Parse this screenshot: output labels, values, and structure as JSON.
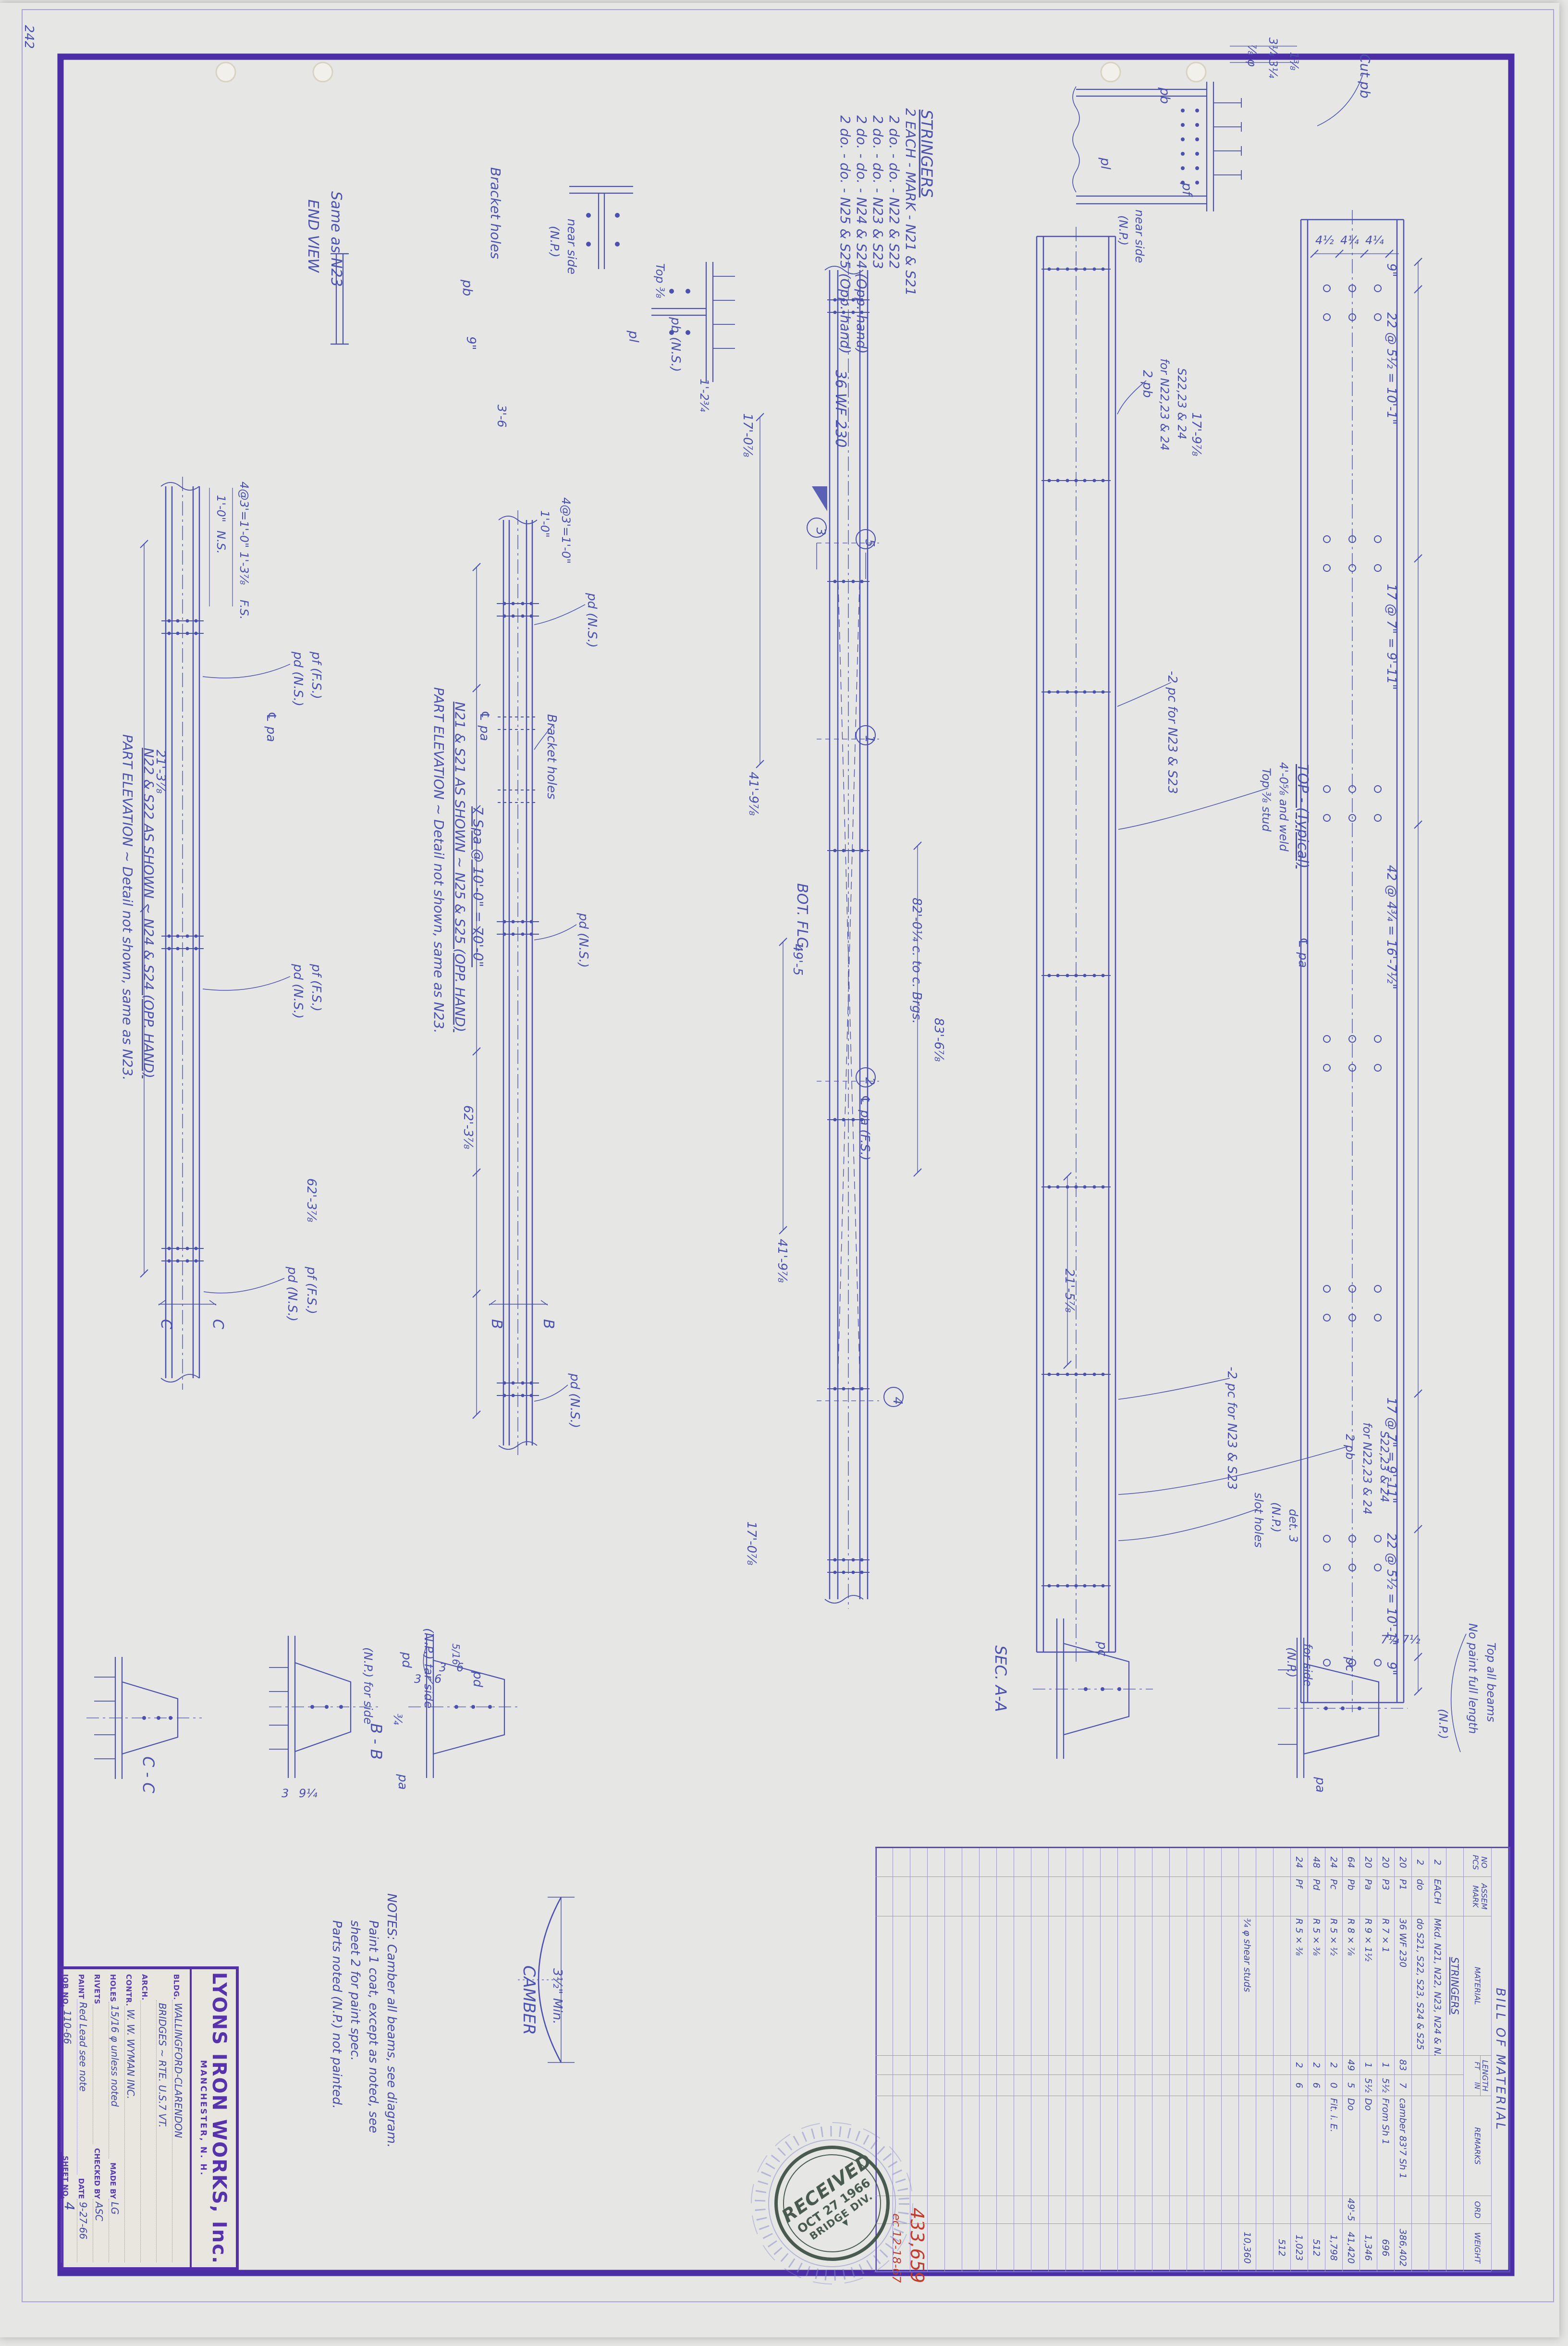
{
  "sheet_corner_number": "242",
  "title_block": {
    "company": "LYONS IRON WORKS, Inc.",
    "city": "MANCHESTER, N. H.",
    "bldg_label": "BLDG.",
    "bldg_value": "WALLINGFORD-CLARENDON",
    "bldg_value2": "BRIDGES ~ RTE. U.S.7  VT.",
    "arch_label": "ARCH.",
    "arch_value": "",
    "contr_label": "CONTR.",
    "contr_value": "W. W. WYMAN INC.",
    "holes_label": "HOLES",
    "holes_value": "15/16 φ unless noted",
    "madeby_label": "MADE BY",
    "madeby_value": "LG",
    "rivets_label": "RIVETS",
    "rivets_value": "",
    "checked_label": "CHECKED BY",
    "checked_value": "ASC",
    "paint_label": "PAINT",
    "paint_value": "Red Lead see note",
    "date_label": "DATE",
    "date_value": "9-27-66",
    "job_label": "JOB NO.",
    "job_value": "110-66",
    "sheet_label": "SHEET NO.",
    "sheet_value": "4"
  },
  "bom": {
    "title": "BILL OF MATERIAL",
    "headers": {
      "pcs1": "NO",
      "pcs2": "PCS",
      "mark1": "ASSEM",
      "mark2": "MARK",
      "material": "MATERIAL",
      "length": "LENGTH",
      "ft": "FT",
      "in": "IN",
      "remarks": "REMARKS",
      "ord": "ORD",
      "weight": "WEIGHT"
    },
    "rows": [
      [
        "",
        "",
        "STRINGERS",
        "",
        "",
        "",
        "",
        ""
      ],
      [
        "2",
        "EACH",
        "Mkd. N21, N22, N23, N24 & N25",
        "",
        "",
        "",
        "",
        ""
      ],
      [
        "2",
        "do",
        "do  S21, S22, S23, S24 & S25",
        "",
        "",
        "",
        "",
        ""
      ],
      [
        "20",
        "P1",
        "36 WF 230",
        "83",
        "7",
        "camber 83'7  Sh 1",
        "",
        "386,402"
      ],
      [
        "20",
        "P3",
        "R 7 × 1",
        "1",
        "5½",
        "From Sh 1",
        "",
        "696"
      ],
      [
        "20",
        "Pa",
        "R 9 × 1½",
        "1",
        "5½",
        "Do",
        "",
        "1,346"
      ],
      [
        "64",
        "Pb",
        "R 8 × ⅞",
        "49",
        "5",
        "Do",
        "49'-5",
        "41,420"
      ],
      [
        "24",
        "Pc",
        "R 5 × ½",
        "2",
        "0",
        "Fit. i. E.",
        "",
        "1,798"
      ],
      [
        "48",
        "Pd",
        "R 5 × ⅜",
        "2",
        "6",
        "",
        "",
        "512"
      ],
      [
        "24",
        "Pf",
        "R 5 × ⅜",
        "2",
        "6",
        "",
        "",
        "1,023"
      ],
      [
        "",
        "",
        "",
        "",
        "",
        "",
        "",
        "512"
      ],
      [
        "",
        "",
        "",
        "",
        "",
        "",
        "",
        ""
      ],
      [
        "",
        "",
        "¾ φ shear studs",
        "",
        "",
        "",
        "",
        "10,360"
      ]
    ],
    "blank_row_total": 34
  },
  "notes": [
    "NOTES: Camber all beams, see diagram.",
    "Paint 1 coat, except as noted, see",
    "sheet 2 for paint spec.",
    "Parts noted (N.P.) not painted."
  ],
  "stamp": {
    "line1": "RECEIVED",
    "line2": "OCT 27 1966",
    "line3": "BRIDGE DIV.",
    "mark": "▼"
  },
  "red_marks": {
    "total": "433,659",
    "note": "ec 12-18-67"
  },
  "ink_color": "#4a51ae",
  "frame_color": "#4b2da6",
  "red_color": "#c23b2c",
  "labels": [
    [
      "242",
      52,
      52,
      90,
      26,
      "h"
    ],
    [
      "END VIEW",
      642,
      415,
      90,
      30,
      "h"
    ],
    [
      "Same as N23",
      690,
      398,
      90,
      30,
      "h"
    ],
    [
      "Bracket holes",
      1022,
      348,
      90,
      28,
      "h"
    ],
    [
      "(N.P.)",
      1146,
      470,
      90,
      25,
      "h"
    ],
    [
      "near side",
      1182,
      455,
      90,
      25,
      "h"
    ],
    [
      "pb",
      964,
      582,
      90,
      27,
      "h"
    ],
    [
      "9\"",
      972,
      700,
      90,
      26,
      "h"
    ],
    [
      "3'-6",
      1036,
      842,
      90,
      25,
      "h"
    ],
    [
      "pl",
      1310,
      688,
      90,
      27,
      "h"
    ],
    [
      "pb (N.S.)",
      1398,
      660,
      90,
      26,
      "h"
    ],
    [
      "Top ⅜",
      1366,
      548,
      90,
      24,
      "h"
    ],
    [
      "1'-2¾",
      1458,
      788,
      90,
      24,
      "h"
    ],
    [
      "STRINGERS",
      1918,
      228,
      90,
      32,
      "hu"
    ],
    [
      "2 EACH - MARK - N21 & S21",
      1886,
      225,
      90,
      28,
      "h"
    ],
    [
      "2 do. -  do.  -  N22 & S22",
      1852,
      240,
      90,
      28,
      "h"
    ],
    [
      "2 do. -  do.  -  N23 & S23",
      1818,
      240,
      90,
      28,
      "h"
    ],
    [
      "2 do. -  do.  -  N24 & S24 (Opp. hand)",
      1784,
      240,
      90,
      28,
      "h"
    ],
    [
      "2 do. -  do.  -  N25 & S25 (Opp. hand)",
      1750,
      240,
      90,
      28,
      "h"
    ],
    [
      "⅞ φ",
      2598,
      92,
      90,
      24,
      "h"
    ],
    [
      "3¼ 3¼",
      2642,
      78,
      90,
      24,
      "h"
    ],
    [
      "1⅜",
      2686,
      108,
      90,
      24,
      "h"
    ],
    [
      "Cut pb",
      2832,
      112,
      90,
      28,
      "h"
    ],
    [
      "pb",
      2416,
      182,
      90,
      27,
      "h"
    ],
    [
      "pl",
      2292,
      328,
      90,
      27,
      "h"
    ],
    [
      "pf",
      2462,
      380,
      90,
      27,
      "h"
    ],
    [
      "(N.P.)",
      2330,
      448,
      90,
      24,
      "h"
    ],
    [
      "near side",
      2364,
      436,
      90,
      24,
      "h"
    ],
    [
      "1'-0\"",
      452,
      1030,
      90,
      24,
      "h"
    ],
    [
      "N.S.",
      452,
      1104,
      90,
      24,
      "h"
    ],
    [
      "4@3'=1'-0\"",
      500,
      1002,
      90,
      24,
      "h"
    ],
    [
      "1'-3⅞",
      500,
      1148,
      90,
      24,
      "h"
    ],
    [
      "F.S.",
      500,
      1248,
      90,
      24,
      "h"
    ],
    [
      "21'-3⅞",
      326,
      1560,
      90,
      26,
      "h"
    ],
    [
      "pd (N.S.)",
      612,
      1356,
      90,
      26,
      "h"
    ],
    [
      "pf (F.S.)",
      650,
      1356,
      90,
      26,
      "h"
    ],
    [
      "℄ pa",
      556,
      1480,
      90,
      26,
      "h"
    ],
    [
      "pd (N.S.)",
      612,
      2006,
      90,
      26,
      "h"
    ],
    [
      "pf (F.S.)",
      650,
      2006,
      90,
      26,
      "h"
    ],
    [
      "62'-3⅞",
      640,
      2452,
      90,
      26,
      "h"
    ],
    [
      "pd (N.S.)",
      600,
      2636,
      90,
      26,
      "h"
    ],
    [
      "pf (F.S.)",
      640,
      2636,
      90,
      26,
      "h"
    ],
    [
      "PART ELEVATION ~ Detail not shown, same as N23.",
      256,
      1528,
      90,
      28,
      "h"
    ],
    [
      "N22 & S22 AS SHOWN ~ N24 & S24 (OPP. HAND)",
      300,
      1556,
      90,
      28,
      "hu"
    ],
    [
      "C",
      336,
      2745,
      90,
      30,
      "h"
    ],
    [
      "C",
      444,
      2745,
      90,
      30,
      "h"
    ],
    [
      "1'-0\"",
      1126,
      1062,
      90,
      24,
      "h"
    ],
    [
      "4@3'=1'-0\"",
      1170,
      1035,
      90,
      24,
      "h"
    ],
    [
      "℄ pa",
      1000,
      1478,
      90,
      26,
      "h"
    ],
    [
      "Bracket holes",
      1140,
      1486,
      90,
      26,
      "h"
    ],
    [
      "pd (N.S.)",
      1224,
      1234,
      90,
      26,
      "h"
    ],
    [
      "7 Spa @ 10'-0\" = 70'-0\"",
      986,
      1678,
      90,
      28,
      "hu"
    ],
    [
      "pd (N.S.)",
      1206,
      1900,
      90,
      26,
      "h"
    ],
    [
      "62'-3⅞",
      966,
      2300,
      90,
      26,
      "h"
    ],
    [
      "pd (N.S.)",
      1188,
      2858,
      90,
      26,
      "h"
    ],
    [
      "PART ELEVATION ~ Detail not shown, same as N23.",
      904,
      1430,
      90,
      28,
      "h"
    ],
    [
      "N21 & S21 AS SHOWN ~ N25 & S25 (OPP. HAND)",
      948,
      1460,
      90,
      28,
      "hu"
    ],
    [
      "B",
      1024,
      2745,
      90,
      30,
      "h"
    ],
    [
      "B",
      1132,
      2745,
      90,
      30,
      "h"
    ],
    [
      "36 WF 230",
      1740,
      770,
      90,
      30,
      "h"
    ],
    [
      "17'-0⅞",
      1548,
      860,
      90,
      26,
      "h"
    ],
    [
      "41'-9⅞",
      1560,
      1606,
      90,
      26,
      "h"
    ],
    [
      "BOT. FLG.",
      1660,
      1838,
      90,
      30,
      "h"
    ],
    [
      "49'-5",
      1652,
      1964,
      90,
      26,
      "h"
    ],
    [
      "℄ pa (F.S.)",
      1792,
      2278,
      90,
      26,
      "h"
    ],
    [
      "41'-9⅞",
      1620,
      2578,
      90,
      26,
      "h"
    ],
    [
      "17'-0⅞",
      1556,
      3166,
      90,
      26,
      "h"
    ],
    [
      "82'-0¼ c. to c. Brgs.",
      1900,
      1868,
      90,
      26,
      "h"
    ],
    [
      "83'-6⅞",
      1946,
      2118,
      90,
      26,
      "h"
    ],
    [
      "3",
      1700,
      1106,
      90,
      26,
      "hc"
    ],
    [
      "5",
      1802,
      1130,
      90,
      26,
      "hc"
    ],
    [
      "1",
      1802,
      1538,
      90,
      26,
      "hc"
    ],
    [
      "2",
      1802,
      2250,
      90,
      26,
      "hc"
    ],
    [
      "4",
      1860,
      2915,
      90,
      26,
      "hc"
    ],
    [
      "2 pb",
      2380,
      770,
      90,
      26,
      "h"
    ],
    [
      "for N22,23 & 24",
      2416,
      746,
      90,
      24,
      "h"
    ],
    [
      "S22,23 & 24",
      2452,
      766,
      90,
      24,
      "h"
    ],
    [
      "-2 pc for N23 & S23",
      2432,
      1396,
      90,
      26,
      "h"
    ],
    [
      "TOP - (Typical)",
      2702,
      1590,
      90,
      30,
      "hu"
    ],
    [
      "Top ⅜ stud",
      2628,
      1598,
      90,
      24,
      "h"
    ],
    [
      "4'-0⅝ and weld",
      2664,
      1586,
      90,
      24,
      "h"
    ],
    [
      "-2 pc for N23 & S23",
      2556,
      2844,
      90,
      26,
      "h"
    ],
    [
      "2 pb",
      2802,
      2984,
      90,
      24,
      "h"
    ],
    [
      "for N22,23 & 24",
      2838,
      2960,
      90,
      24,
      "h"
    ],
    [
      "S22,23 & 24",
      2874,
      2978,
      90,
      24,
      "h"
    ],
    [
      "slot holes",
      2612,
      3106,
      90,
      24,
      "h"
    ],
    [
      "(N.P.)",
      2648,
      3126,
      90,
      24,
      "h"
    ],
    [
      "det. 3",
      2684,
      3140,
      90,
      24,
      "h"
    ],
    [
      "21'-5⅞",
      2218,
      2640,
      90,
      26,
      "h"
    ],
    [
      "17'-9⅞",
      2482,
      858,
      90,
      26,
      "h"
    ],
    [
      "℄ pa",
      2704,
      1950,
      90,
      26,
      "h"
    ],
    [
      "4½",
      2738,
      508,
      0,
      24,
      "h"
    ],
    [
      "4¼",
      2790,
      508,
      0,
      24,
      "h"
    ],
    [
      "4¼",
      2842,
      508,
      0,
      24,
      "h"
    ],
    [
      "9\"",
      2888,
      548,
      90,
      26,
      "h"
    ],
    [
      "22 @ 5½ = 10'-1\"",
      2888,
      650,
      90,
      26,
      "h"
    ],
    [
      "17 @ 7\" = 9'-11\"",
      2888,
      1215,
      90,
      26,
      "h"
    ],
    [
      "42 @ 4¾ = 16'-7½\"",
      2888,
      1800,
      90,
      26,
      "h"
    ],
    [
      "17 @ 7\" = 9'-11\"",
      2888,
      2908,
      90,
      26,
      "h"
    ],
    [
      "22 @ 5½ = 10'-1\"",
      2888,
      3190,
      90,
      26,
      "h"
    ],
    [
      "9\"",
      2888,
      3458,
      90,
      26,
      "h"
    ],
    [
      "C - C",
      298,
      3655,
      90,
      32,
      "h"
    ],
    [
      "(N.P.) for side",
      758,
      3428,
      90,
      24,
      "h"
    ],
    [
      "pd",
      838,
      3438,
      90,
      26,
      "h"
    ],
    [
      "3",
      862,
      3502,
      0,
      24,
      "h"
    ],
    [
      "6",
      904,
      3502,
      0,
      24,
      "h"
    ],
    [
      "B - B",
      772,
      3586,
      90,
      32,
      "h"
    ],
    [
      "3",
      586,
      3740,
      0,
      24,
      "h"
    ],
    [
      "9¼",
      622,
      3740,
      0,
      24,
      "h"
    ],
    [
      "(N.P.) far side",
      884,
      3388,
      90,
      25,
      "h"
    ],
    [
      "pd",
      986,
      3478,
      90,
      26,
      "h"
    ],
    [
      "3",
      914,
      3478,
      0,
      24,
      "h"
    ],
    [
      "6",
      950,
      3478,
      0,
      24,
      "h"
    ],
    [
      "¾",
      820,
      3566,
      90,
      24,
      "h"
    ],
    [
      "pa",
      830,
      3692,
      90,
      26,
      "h"
    ],
    [
      "5/16",
      942,
      3420,
      90,
      20,
      "h"
    ],
    [
      "SEC. A-A",
      2072,
      3424,
      90,
      32,
      "h"
    ],
    [
      "pc",
      2286,
      3416,
      90,
      26,
      "h"
    ],
    [
      "(N.P.)",
      2680,
      3428,
      90,
      24,
      "h"
    ],
    [
      "for side",
      2714,
      3420,
      90,
      24,
      "h"
    ],
    [
      "pc",
      2802,
      3448,
      90,
      26,
      "h"
    ],
    [
      "pa",
      2740,
      3698,
      90,
      26,
      "h"
    ],
    [
      "7¼",
      2874,
      3420,
      0,
      24,
      "h"
    ],
    [
      "7½",
      2918,
      3420,
      0,
      24,
      "h"
    ],
    [
      "No paint full length",
      3058,
      3378,
      90,
      24,
      "h"
    ],
    [
      "Top all beams",
      3096,
      3418,
      90,
      24,
      "h"
    ],
    [
      "(N.P.)",
      2996,
      3556,
      90,
      24,
      "h"
    ],
    [
      "CAMBER",
      1090,
      4090,
      90,
      34,
      "h"
    ],
    [
      "3½\" Min.",
      1152,
      4096,
      90,
      26,
      "h"
    ],
    [
      "433,659",
      1896,
      4594,
      90,
      38,
      "r"
    ],
    [
      "ec 12-18-67",
      1858,
      4606,
      90,
      24,
      "r"
    ]
  ]
}
